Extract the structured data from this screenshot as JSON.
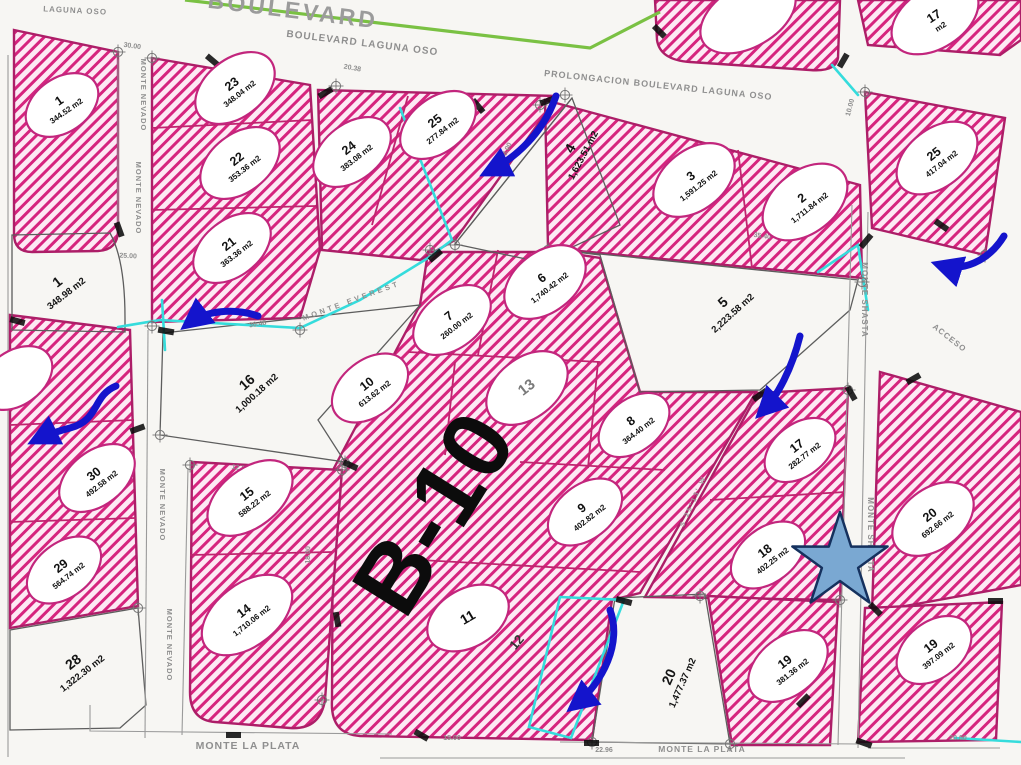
{
  "map_title": "B-10",
  "streets": {
    "corner": "LAGUNA OSO",
    "boulevard_large": "BOULEVARD",
    "boulevard": "BOULEVARD LAGUNA OSO",
    "prolongacion": "PROLONGACION BOULEVARD LAGUNA OSO",
    "monte_nevado": "MONTE NEVADO",
    "monte_shasta": "MONTE SHASTA",
    "acceso": "ACCESO",
    "monte_la_plata": "MONTE LA PLATA",
    "monte_everest": "MONTE EVEREST",
    "bearing": "S 25°13' W"
  },
  "lots": [
    {
      "number": "1",
      "area": "344.52 m2",
      "hatched": true
    },
    {
      "number": "1",
      "area": "348.98 m2",
      "hatched": false
    },
    {
      "number": "23",
      "area": "348.04 m2",
      "hatched": true
    },
    {
      "number": "22",
      "area": "353.36 m2",
      "hatched": true
    },
    {
      "number": "21",
      "area": "363.36 m2",
      "hatched": true
    },
    {
      "number": "24",
      "area": "383.08 m2",
      "hatched": true
    },
    {
      "number": "25",
      "area": "277.84 m2",
      "hatched": true
    },
    {
      "number": "4",
      "area": "1,623.51 m2",
      "hatched": false
    },
    {
      "number": "3",
      "area": "1,591.25 m2",
      "hatched": true
    },
    {
      "number": "2",
      "area": "1,711.84 m2",
      "hatched": true
    },
    {
      "number": "25",
      "area": "417.04 m2",
      "hatched": true
    },
    {
      "number": "17",
      "area": "m2",
      "hatched": true
    },
    {
      "number": "5",
      "area": "2,223.58 m2",
      "hatched": false
    },
    {
      "number": "6",
      "area": "1,740.42 m2",
      "hatched": true
    },
    {
      "number": "7",
      "area": "260.00 m2",
      "hatched": true
    },
    {
      "number": "10",
      "area": "613.62 m2",
      "hatched": true
    },
    {
      "number": "13",
      "area": "",
      "hatched": true
    },
    {
      "number": "8",
      "area": "364.40 m2",
      "hatched": true
    },
    {
      "number": "9",
      "area": "402.82 m2",
      "hatched": true
    },
    {
      "number": "16",
      "area": "1,000.18 m2",
      "hatched": false
    },
    {
      "number": "11",
      "area": "",
      "hatched": true
    },
    {
      "number": "12",
      "area": "",
      "hatched": true
    },
    {
      "number": "15",
      "area": "588.22 m2",
      "hatched": true
    },
    {
      "number": "14",
      "area": "1,710.06 m2",
      "hatched": true
    },
    {
      "number": "30",
      "area": "492.58 m2",
      "hatched": true
    },
    {
      "number": "29",
      "area": "564.74 m2",
      "hatched": true
    },
    {
      "number": "28",
      "area": "1,322.30 m2",
      "hatched": false
    },
    {
      "number": "17",
      "area": "282.77 m2",
      "hatched": true
    },
    {
      "number": "18",
      "area": "402.25 m2",
      "hatched": true
    },
    {
      "number": "20",
      "area": "692.66 m2",
      "hatched": true
    },
    {
      "number": "19",
      "area": "381.36 m2",
      "hatched": true
    },
    {
      "number": "19",
      "area": "397.09 m2",
      "hatched": true
    },
    {
      "number": "20",
      "area": "1,477.37 m2",
      "hatched": false
    }
  ],
  "dims": [
    "30.00",
    "20.38",
    "35.40",
    "8.00",
    "30.48",
    "25.00",
    "15.00",
    "19.01",
    "18.00",
    "22.96",
    "10.00",
    "16.00",
    "20.00",
    "12.50"
  ],
  "colors": {
    "hatch_stripe": "#d6247e",
    "hatch_bg": "#fde9f4",
    "parcel_stroke": "#ad1e68",
    "cyan": "#35dcdc",
    "arrow_blue": "#1414cc",
    "star_fill": "#7aa8d2",
    "star_stroke": "#15315e",
    "green_line": "#7ac143"
  }
}
